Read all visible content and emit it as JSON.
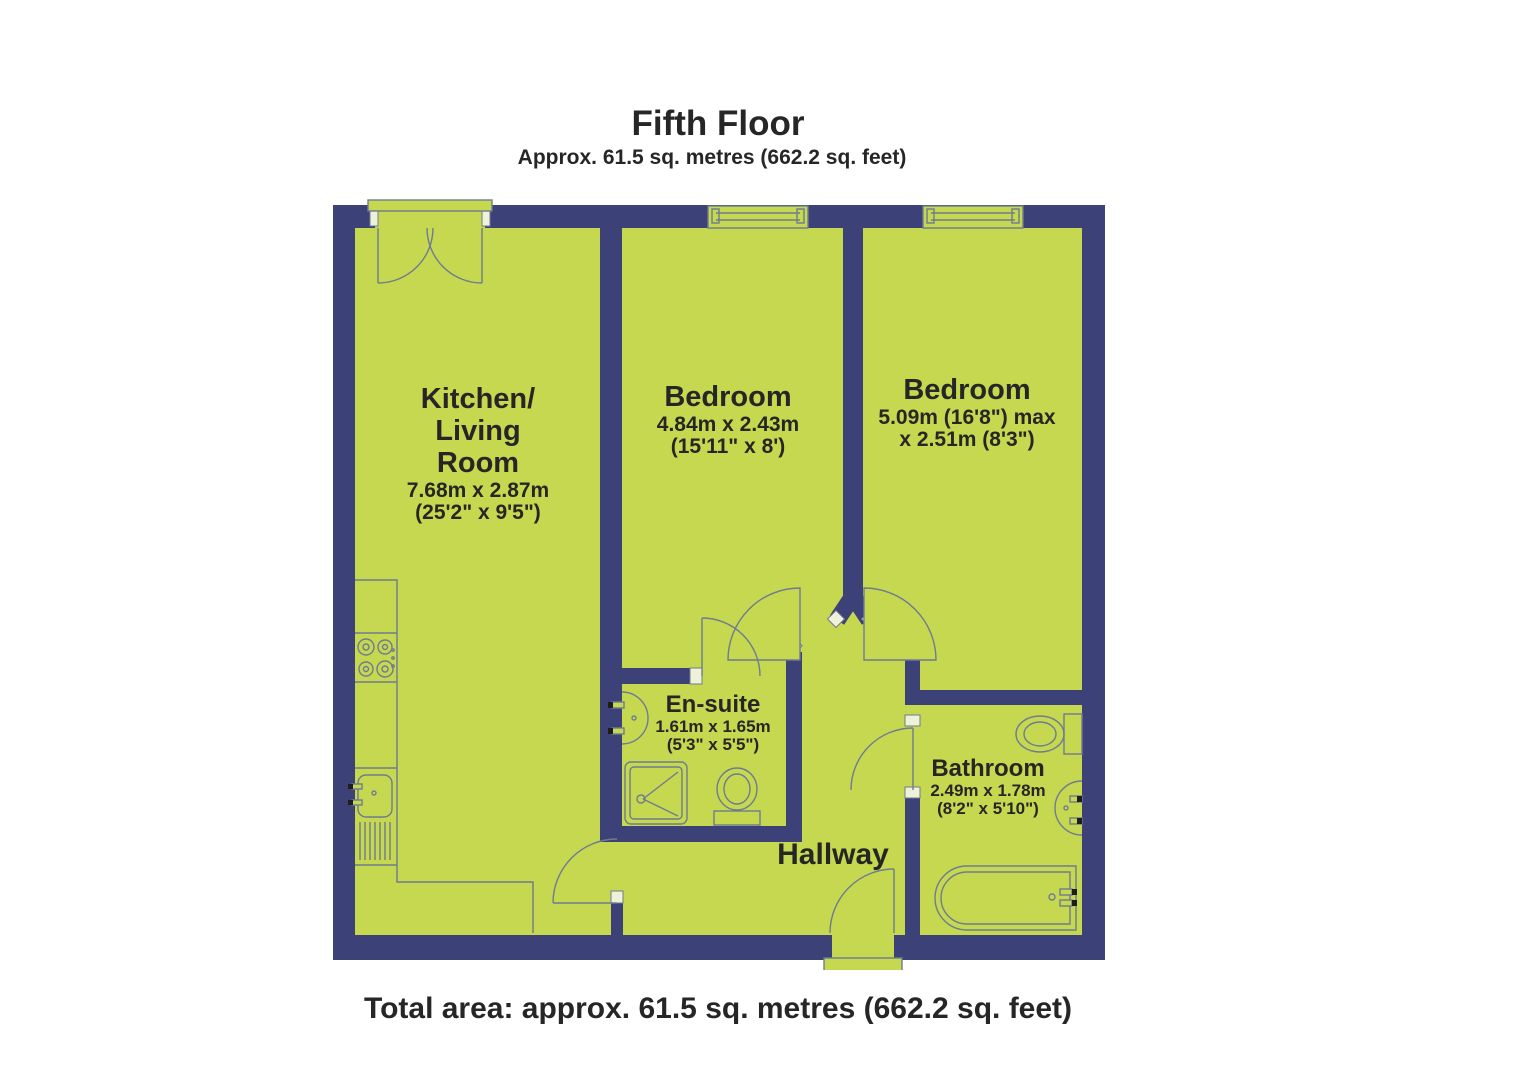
{
  "title": "Fifth Floor",
  "subtitle": "Approx. 61.5 sq. metres (662.2 sq. feet)",
  "footer": "Total area: approx. 61.5 sq. metres (662.2 sq. feet)",
  "colors": {
    "background": "#ffffff",
    "room_fill": "#c6d84f",
    "wall": "#3c4277",
    "line": "#6f7b93",
    "jamb": "#eef2d8",
    "text": "#262626"
  },
  "rooms": {
    "kitchen": {
      "name_line1": "Kitchen/",
      "name_line2": "Living",
      "name_line3": "Room",
      "dims_metric": "7.68m x 2.87m",
      "dims_imperial": "(25'2\" x 9'5\")"
    },
    "bedroom1": {
      "name": "Bedroom",
      "dims_metric": "4.84m x 2.43m",
      "dims_imperial": "(15'11\" x 8')"
    },
    "bedroom2": {
      "name": "Bedroom",
      "dims_line1": "5.09m (16'8\") max",
      "dims_line2": "x 2.51m (8'3\")"
    },
    "ensuite": {
      "name": "En-suite",
      "dims_metric": "1.61m x 1.65m",
      "dims_imperial": "(5'3\" x 5'5\")"
    },
    "bathroom": {
      "name": "Bathroom",
      "dims_metric": "2.49m x 1.78m",
      "dims_imperial": "(8'2\" x 5'10\")"
    },
    "hallway": {
      "name": "Hallway"
    }
  }
}
